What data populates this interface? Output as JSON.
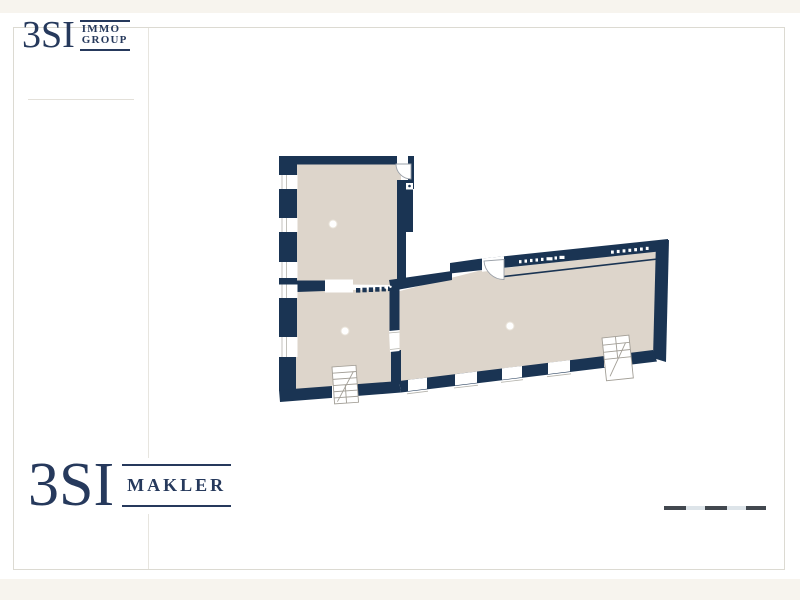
{
  "brand": {
    "name": "3SI",
    "color": "#26395c",
    "header": {
      "line1": "IMMO",
      "line2": "GROUP"
    },
    "footer": {
      "label": "MAKLER"
    }
  },
  "floorplan": {
    "wall_color": "#1a3453",
    "floor_color": "#ddd5cb",
    "rooms": [
      "upper-left-room",
      "lower-left-room",
      "main-hall"
    ],
    "ceiling_lights": 3,
    "door_arcs": 2,
    "stair_symbols": 2,
    "left_wall_windows": 5,
    "bottom_wall_windows": 4
  },
  "page": {
    "background_cream": "#f7f4ee",
    "card_border": "#dcdad2"
  },
  "scale_bar": {
    "segment_colors": [
      "#42484f",
      "#dde4e9",
      "#42484f",
      "#dde4e9",
      "#42484f"
    ]
  }
}
